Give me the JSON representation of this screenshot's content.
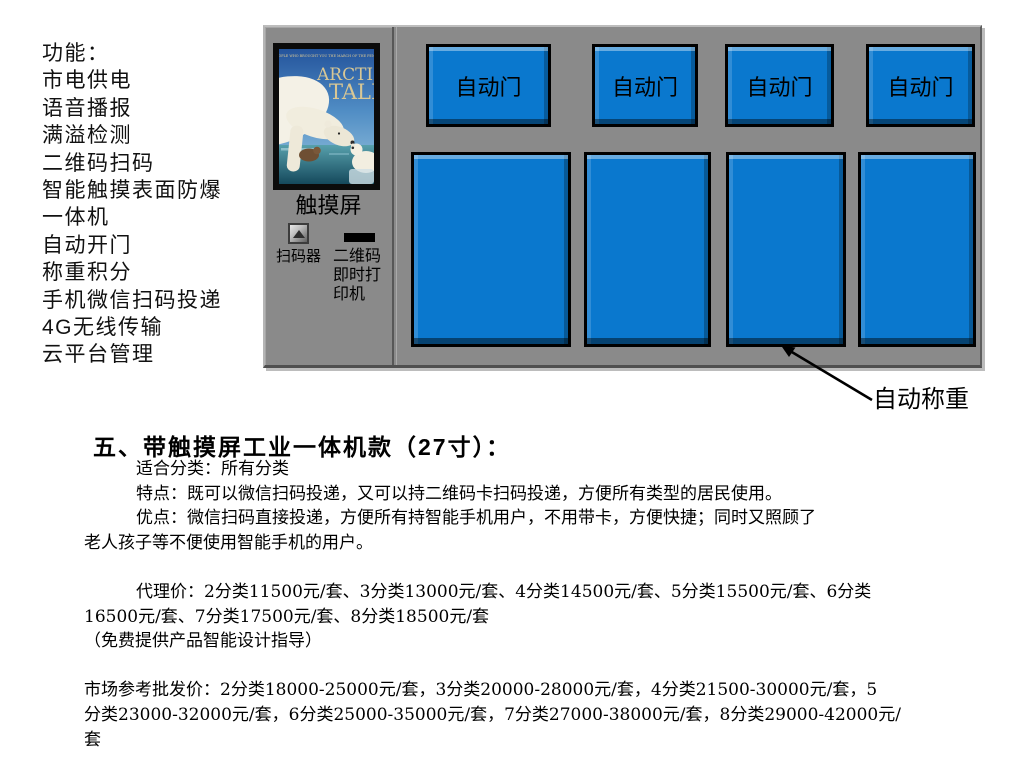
{
  "colors": {
    "panel_gray": "#8a8a8a",
    "accent_blue": "#0a78ce",
    "poster_title_tan": "#d8c795"
  },
  "features": {
    "title": "功能：",
    "items": [
      "市电供电",
      "语音播报",
      "满溢检测",
      "二维码扫码",
      "智能触摸表面防爆",
      "一体机",
      "自动开门",
      "称重积分",
      "手机微信扫码投递",
      "4G无线传输",
      "云平台管理"
    ]
  },
  "machine": {
    "poster": {
      "tagline": "THE PEOPLE WHO BROUGHT YOU THE MARCH OF THE PENGUINS",
      "title_line1": "ARCTIC",
      "title_line2": "TALE"
    },
    "touch_screen_label": "触摸屏",
    "scanner_label": "扫码器",
    "printer_label_lines": [
      "二维码",
      "即时打",
      "印机"
    ],
    "door_buttons": [
      "自动门",
      "自动门",
      "自动门",
      "自动门"
    ],
    "weigh_label": "自动称重"
  },
  "details": {
    "heading": "五、带触摸屏工业一体机款（27寸）：",
    "fit_line": "适合分类：所有分类",
    "feature_line": "特点：既可以微信扫码投递，又可以持二维码卡扫码投递，方便所有类型的居民使用。",
    "advantage_line1": "优点：微信扫码直接投递，方便所有持智能手机用户，不用带卡，方便快捷；同时又照顾了",
    "advantage_line2": "老人孩子等不便使用智能手机的用户。",
    "agent_price_line1": "代理价：2分类11500元/套、3分类13000元/套、4分类14500元/套、5分类15500元/套、6分类",
    "agent_price_line2": "16500元/套、7分类17500元/套、8分类18500元/套",
    "free_design_line": "（免费提供产品智能设计指导）",
    "market_price_line1": "市场参考批发价：2分类18000-25000元/套，3分类20000-28000元/套，4分类21500-30000元/套，5",
    "market_price_line2": "分类23000-32000元/套，6分类25000-35000元/套，7分类27000-38000元/套，8分类29000-42000元/",
    "market_price_line3": "套"
  }
}
